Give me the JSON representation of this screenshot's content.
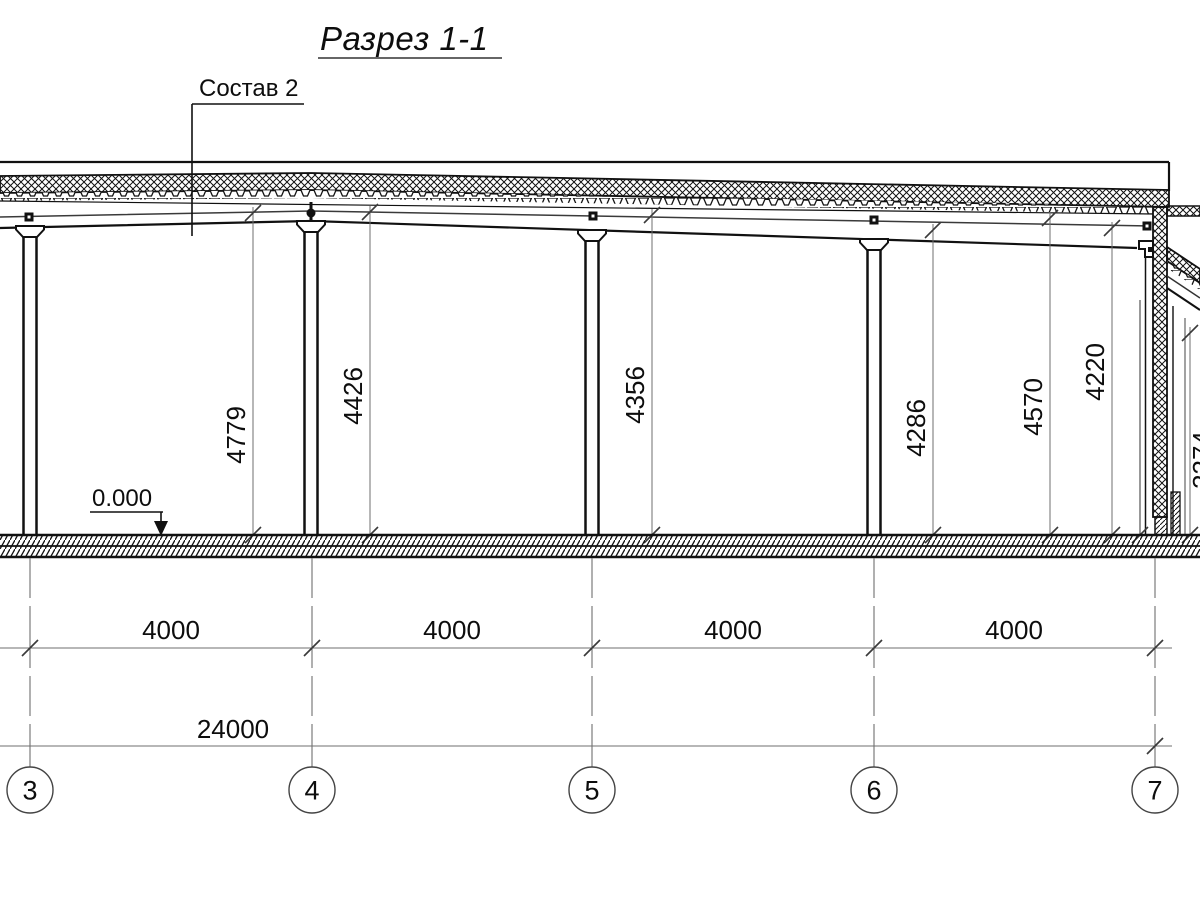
{
  "title": "Разрез 1-1",
  "annotations": {
    "composition_label": "Состав 2",
    "level_mark": "0.000"
  },
  "vertical_dimensions": [
    {
      "value": "4779"
    },
    {
      "value": "4426"
    },
    {
      "value": "4356"
    },
    {
      "value": "4286"
    },
    {
      "value": "4570"
    },
    {
      "value": "4220"
    },
    {
      "value": "3374"
    }
  ],
  "bay_dimensions": [
    {
      "value": "4000"
    },
    {
      "value": "4000"
    },
    {
      "value": "4000"
    },
    {
      "value": "4000"
    }
  ],
  "overall_dimension": {
    "value": "24000"
  },
  "grid_axes": [
    {
      "label": "3"
    },
    {
      "label": "4"
    },
    {
      "label": "5"
    },
    {
      "label": "6"
    },
    {
      "label": "7"
    }
  ],
  "colors": {
    "line": "#111111",
    "dim_line": "#6f6f6f",
    "background": "#ffffff"
  }
}
